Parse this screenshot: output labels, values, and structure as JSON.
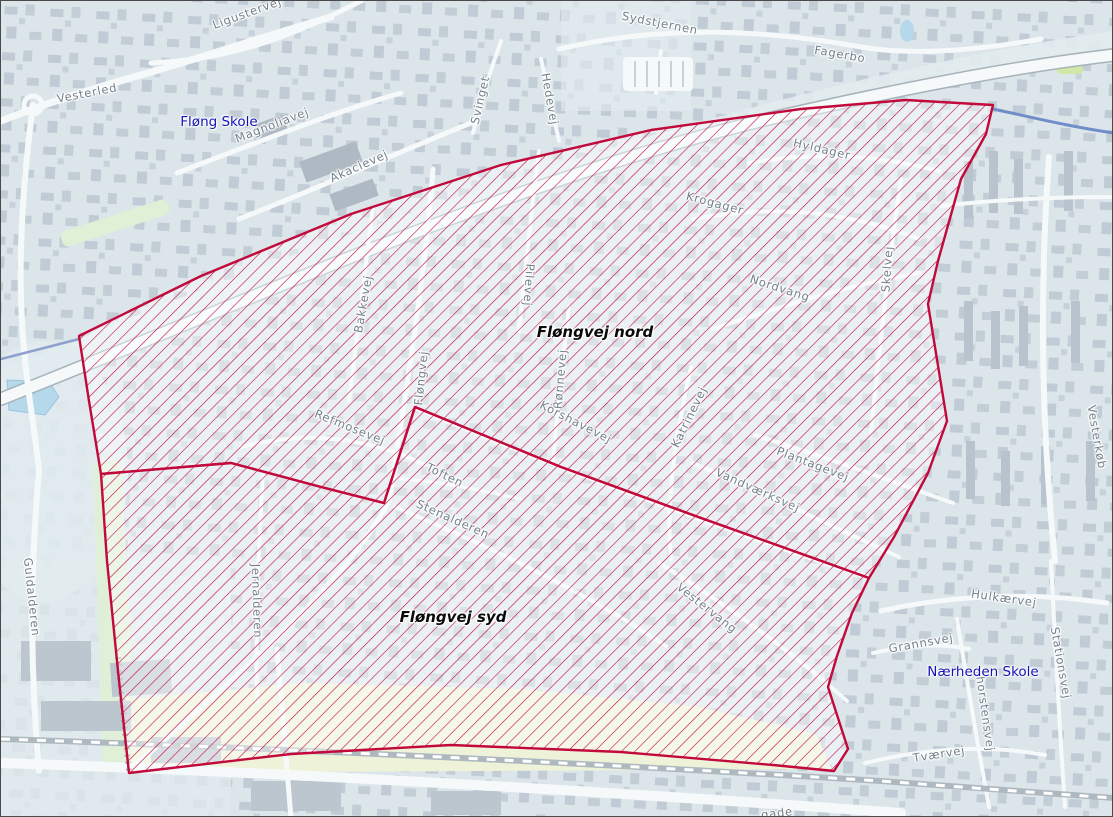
{
  "map": {
    "colors": {
      "zone-red": "#c2093b",
      "poi-blue": "#1313b5",
      "street-gray": "#73808b",
      "region-label": "#0a0a0a"
    },
    "zones": {
      "north": "78,335 200,275 350,213 500,164 650,129 800,108 905,99 992,104 985,133 960,178 937,260 927,303 946,420 927,472 893,536 868,577 700,517 560,466 414,406 383,502 320,486 230,462 100,473 88,400",
      "south": "100,473 230,462 320,486 383,502 414,406 560,466 700,517 868,577 851,612 836,655 827,686 847,748 833,770 772,764 620,751 450,744 290,753 128,772 117,670 106,560"
    },
    "region_labels": [
      {
        "text": "Fløngvej nord",
        "x": 594,
        "y": 331,
        "rot": 0
      },
      {
        "text": "Fløngvej syd",
        "x": 452,
        "y": 616,
        "rot": 0
      }
    ],
    "poi_labels": [
      {
        "text": "Fløng Skole",
        "x": 218,
        "y": 121,
        "rot": 0
      },
      {
        "text": "Nærheden Skole",
        "x": 982,
        "y": 671,
        "rot": 0
      }
    ],
    "street_labels": [
      {
        "text": "Ligustervej",
        "x": 246,
        "y": 12,
        "rot": -20
      },
      {
        "text": "Vesterled",
        "x": 86,
        "y": 92,
        "rot": -11
      },
      {
        "text": "Magnoliavej",
        "x": 271,
        "y": 124,
        "rot": -21
      },
      {
        "text": "Akacievej",
        "x": 358,
        "y": 165,
        "rot": -24
      },
      {
        "text": "Svinget",
        "x": 479,
        "y": 99,
        "rot": -77
      },
      {
        "text": "Hedevej",
        "x": 549,
        "y": 98,
        "rot": 80
      },
      {
        "text": "Sydstjernen",
        "x": 659,
        "y": 22,
        "rot": 11
      },
      {
        "text": "Fagerbo",
        "x": 839,
        "y": 53,
        "rot": 10
      },
      {
        "text": "Hyldager",
        "x": 821,
        "y": 148,
        "rot": 13
      },
      {
        "text": "Krogager",
        "x": 714,
        "y": 202,
        "rot": 15
      },
      {
        "text": "Nordvang",
        "x": 779,
        "y": 287,
        "rot": 18
      },
      {
        "text": "Skelvej",
        "x": 886,
        "y": 268,
        "rot": -86
      },
      {
        "text": "Bakkevej",
        "x": 362,
        "y": 303,
        "rot": -80
      },
      {
        "text": "Pilevej",
        "x": 528,
        "y": 284,
        "rot": 94
      },
      {
        "text": "Rønnevej",
        "x": 559,
        "y": 378,
        "rot": -85
      },
      {
        "text": "Fløngvej",
        "x": 420,
        "y": 377,
        "rot": -84
      },
      {
        "text": "Katrinevej",
        "x": 688,
        "y": 416,
        "rot": -64
      },
      {
        "text": "Korshavevej",
        "x": 575,
        "y": 421,
        "rot": 27
      },
      {
        "text": "Refmosevej",
        "x": 349,
        "y": 426,
        "rot": 22
      },
      {
        "text": "Toften",
        "x": 444,
        "y": 474,
        "rot": 26
      },
      {
        "text": "Stenalderen",
        "x": 452,
        "y": 518,
        "rot": 24
      },
      {
        "text": "Jernalderen",
        "x": 256,
        "y": 600,
        "rot": 88
      },
      {
        "text": "Guldalderen",
        "x": 31,
        "y": 596,
        "rot": 84
      },
      {
        "text": "Vandværksvej",
        "x": 757,
        "y": 489,
        "rot": 24
      },
      {
        "text": "Plantagevej",
        "x": 812,
        "y": 463,
        "rot": 21
      },
      {
        "text": "Vestervang",
        "x": 706,
        "y": 607,
        "rot": 38
      },
      {
        "text": "Vesterkøb",
        "x": 1096,
        "y": 436,
        "rot": 80
      },
      {
        "text": "Hulkærvej",
        "x": 1003,
        "y": 597,
        "rot": 8
      },
      {
        "text": "Grannsvej",
        "x": 920,
        "y": 642,
        "rot": -10
      },
      {
        "text": "Thorstensvej",
        "x": 984,
        "y": 709,
        "rot": 82
      },
      {
        "text": "Stationsvej",
        "x": 1060,
        "y": 662,
        "rot": 80
      },
      {
        "text": "Tværvej",
        "x": 938,
        "y": 753,
        "rot": -9
      },
      {
        "text": "gade",
        "x": 776,
        "y": 812,
        "rot": -7
      }
    ]
  }
}
